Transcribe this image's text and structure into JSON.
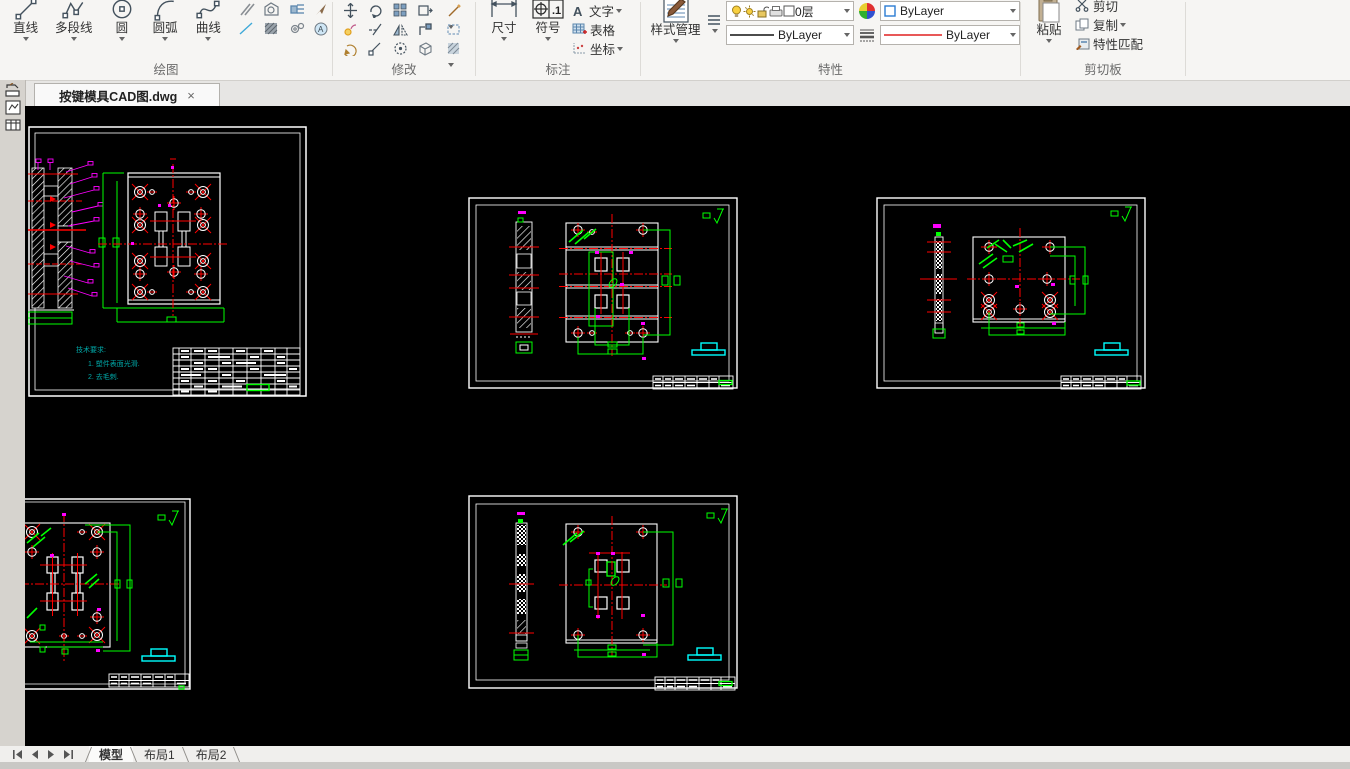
{
  "ribbon": {
    "draw": {
      "label": "绘图",
      "line": "直线",
      "polyline": "多段线",
      "circle": "圆",
      "arc": "圆弧",
      "spline": "曲线"
    },
    "modify": {
      "label": "修改"
    },
    "annotate": {
      "label": "标注",
      "dimension": "尺寸",
      "symbol": "符号",
      "text": "文字",
      "table": "表格",
      "coordinate": "坐标",
      "text_icon": "A",
      "symbol_icon_text": ".1"
    },
    "properties": {
      "label": "特性",
      "style_manager": "样式管理",
      "layer_value": "0层",
      "color_value": "ByLayer",
      "lineweight_value": "ByLayer",
      "linetype_value": "ByLayer"
    },
    "clipboard": {
      "label": "剪切板",
      "paste": "粘贴",
      "cut": "剪切",
      "copy": "复制",
      "match": "特性匹配"
    }
  },
  "file_tab": {
    "title": "按键模具CAD图.dwg",
    "close": "×"
  },
  "drawing": {
    "notes": [
      "技术要求:",
      "1. 塑件表面光滑.",
      "2. 去毛刺."
    ],
    "note_color": "#00a8a8"
  },
  "bottom_bar": {
    "tabs": [
      "模型",
      "布局1",
      "布局2"
    ],
    "active_tab": "模型"
  },
  "colors": {
    "canvas": "#000000",
    "white": "#ffffff",
    "green": "#00ff00",
    "red": "#ff0000",
    "magenta": "#ff00ff",
    "cyan": "#00ffff"
  }
}
